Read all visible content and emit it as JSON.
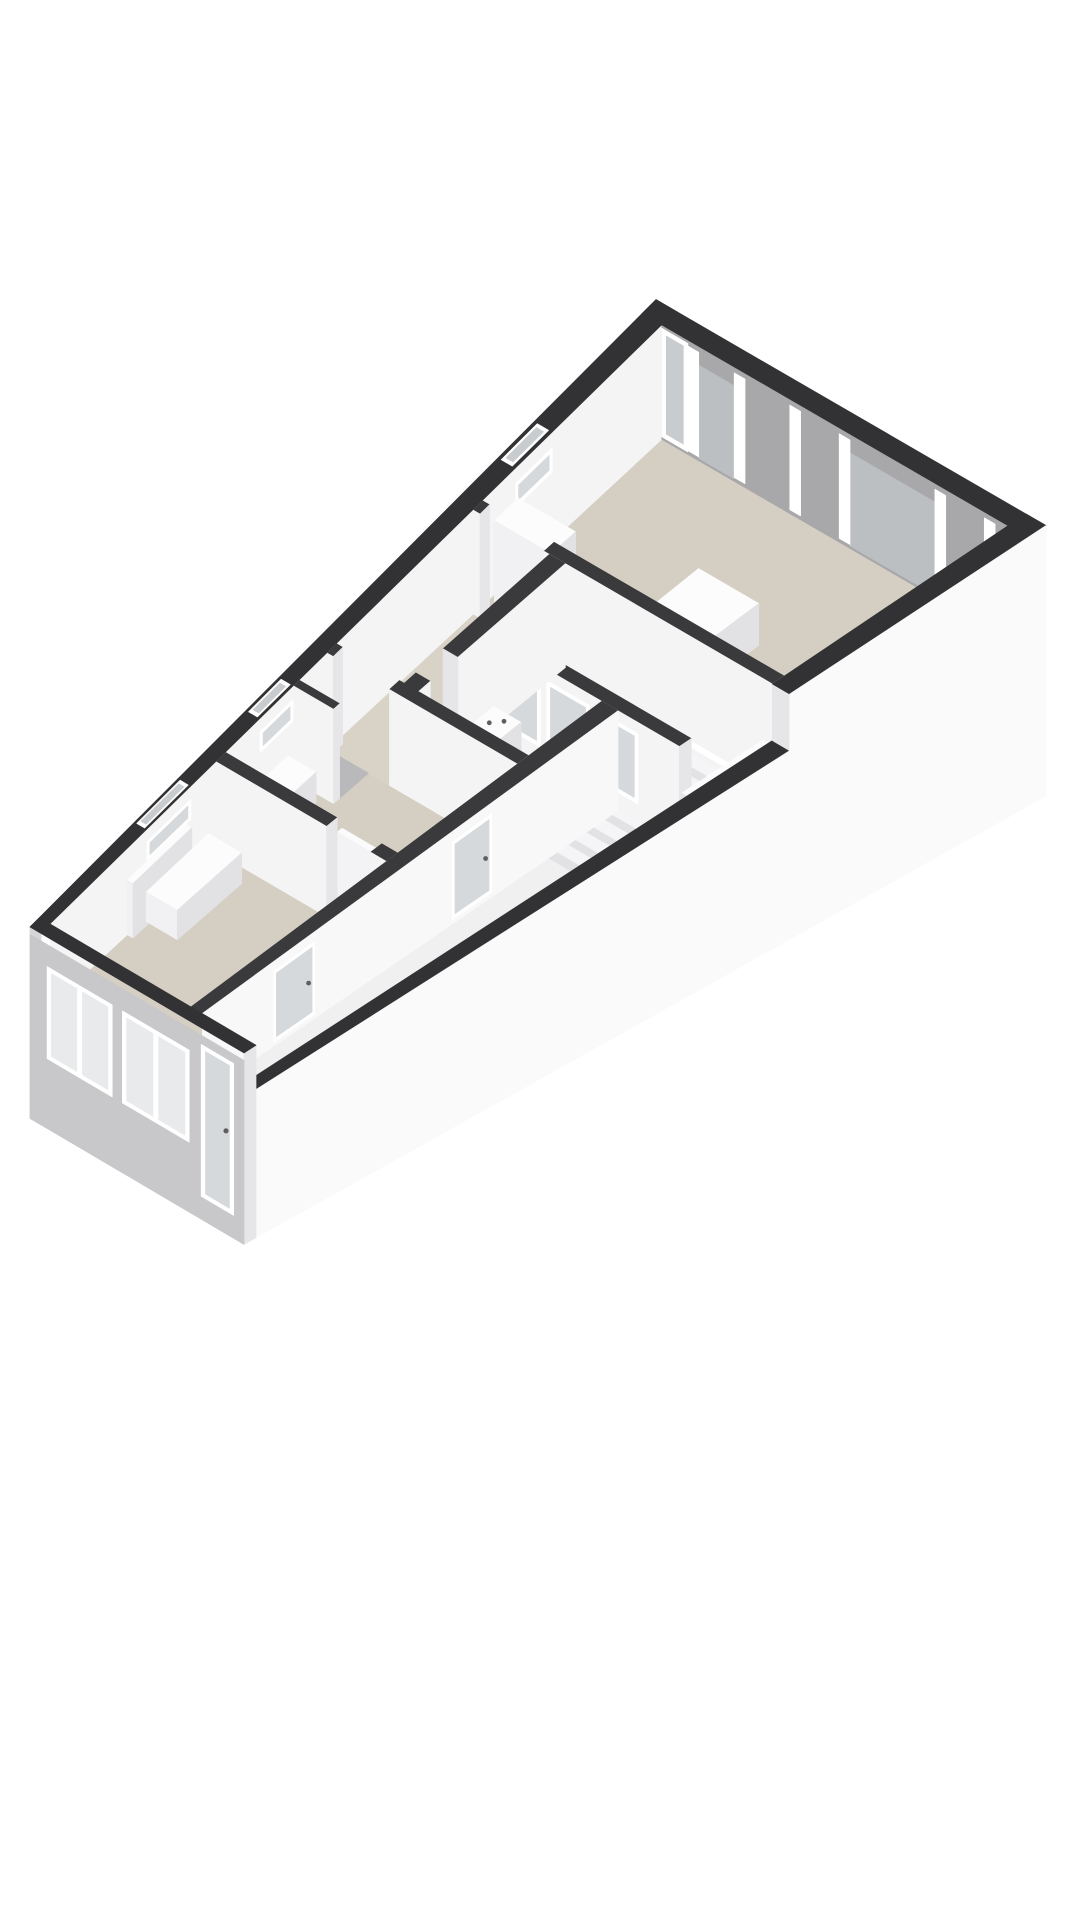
{
  "scene": {
    "kind": "3d-floorplan-isometric-render",
    "background": "#ffffff"
  },
  "palette": {
    "wall_top": "#323234",
    "wall_top_partition": "#3a3a3c",
    "wall_face": "#f4f4f5",
    "wall_face_bright": "#f8f8f9",
    "wall_cap": "#e6e6e8",
    "ne_wall": "#a8a8aa",
    "ne_panel": "#bcbfc1",
    "frame": "#ffffff",
    "glass": "#e8eaec",
    "glass_dark": "#d6d9dc",
    "floor": "#d5cec2",
    "floor_light": "#d9d3c7",
    "floor_gallery": "#f0f0f1",
    "floor_niche": "#b9b9bb",
    "pit_floor": "#c6c6c8",
    "shaft_nw": "#e9e9eb",
    "shaft_e": "#f3f3f4",
    "facade_front": "#c8c8ca",
    "facade_side": "#fafafb",
    "furn_top": "#fcfcfd",
    "furn_sw": "#f1f1f3",
    "furn_se": "#e2e2e5",
    "tread_top": "#f5f5f7",
    "tread_front": "#e2e2e5",
    "toilet_rim": "#8a8a8d",
    "toilet_inner": "#ebebee",
    "metal": "#5f5f62",
    "post": "#dcdcde"
  },
  "model": {
    "building": {
      "length": 870,
      "width": 250,
      "wall_height": 88,
      "plinth": 120,
      "corners": {
        "w": [
          30,
          1008
        ],
        "n": [
          656,
          414
        ],
        "e": [
          1046,
          640
        ],
        "s": [
          244,
          1134
        ]
      }
    },
    "floors": [
      {
        "name": "room-c-floor",
        "r": [
          605,
          13,
          857,
          237
        ],
        "c": "floor"
      },
      {
        "name": "corridor-floor",
        "r": [
          405,
          13,
          592,
          82
        ],
        "c": "floor_light"
      },
      {
        "name": "wc-floor",
        "r": [
          405,
          82,
          490,
          175
        ],
        "c": "floor_light"
      },
      {
        "name": "room-b-floor",
        "r": [
          253,
          13,
          392,
          175
        ],
        "c": "floor"
      },
      {
        "name": "room-a-floor",
        "r": [
          13,
          13,
          240,
          175
        ],
        "c": "floor"
      },
      {
        "name": "threshold-a-b",
        "r": [
          240,
          118,
          253,
          160
        ],
        "c": "floor"
      },
      {
        "name": "threshold-b-hall",
        "r": [
          392,
          18,
          405,
          66
        ],
        "c": "floor_light"
      },
      {
        "name": "threshold-hall-c",
        "r": [
          592,
          18,
          605,
          66
        ],
        "c": "floor"
      },
      {
        "name": "threshold-wc",
        "r": [
          420,
          70,
          455,
          82
        ],
        "c": "floor_light"
      },
      {
        "name": "niche-floor",
        "r": [
          354,
          13,
          392,
          48
        ],
        "c": "floor_niche"
      },
      {
        "name": "gallery-floor",
        "r": [
          13,
          188,
          490,
          237
        ],
        "c": "floor_gallery"
      }
    ],
    "nw_wall": {
      "slits": [
        [
          145,
          205
        ],
        [
          300,
          345
        ],
        [
          650,
          700
        ]
      ]
    },
    "ne_wall": {
      "u0": 850,
      "u1": 870,
      "door_frame": [
        13,
        30
      ],
      "panels": [
        [
          37,
          60
        ],
        [
          135,
          190
        ]
      ],
      "mullions": [
        [
          30,
          37
        ],
        [
          60,
          67
        ],
        [
          96,
          103
        ],
        [
          128,
          135
        ],
        [
          190,
          197
        ],
        [
          222,
          229
        ]
      ]
    },
    "partition_hall_c": {
      "u": 592,
      "t": 13,
      "v0": 13,
      "v1": 237,
      "gap": [
        18,
        66
      ]
    },
    "partition_b_hall": {
      "u": 392,
      "t": 13,
      "v0": 13,
      "v1": 175,
      "gap": [
        18,
        66
      ]
    },
    "partition_a_b": {
      "u": 240,
      "t": 13,
      "v0": 13,
      "v1": 175,
      "gap": [
        118,
        160
      ]
    },
    "shaft_west_wall": {
      "u": 490,
      "t": 13,
      "v0": 82,
      "v1": 237,
      "panes": [
        [
          92,
          126
        ],
        [
          131,
          165
        ],
        [
          170,
          204
        ]
      ]
    },
    "wc_wall": {
      "v": 70,
      "t": 12,
      "u0": 405,
      "u1": 592,
      "gap": [
        420,
        455
      ]
    },
    "se_inner_wall": {
      "v": 175,
      "t": 13,
      "u0": 13,
      "u1": 490,
      "glass_doors": [
        [
          95,
          142
        ],
        [
          300,
          345
        ]
      ]
    },
    "stairs": {
      "shaft": [
        503,
        82,
        585,
        230
      ],
      "pit_depth": 64,
      "tread_count": 8,
      "tread_depth": 13,
      "top_u": 585,
      "v0": 92,
      "v1": 226,
      "drop": 8,
      "balustrade": {
        "u0": 503,
        "u1": 592,
        "v0": 230,
        "v1": 237,
        "h": 36,
        "posts": 6
      }
    },
    "kitchen": [
      {
        "name": "kitchen-counter",
        "box": [
          608,
          20,
          640,
          150,
          40
        ]
      },
      {
        "name": "kitchen-tall-cabinet",
        "box": [
          608,
          20,
          640,
          62,
          74
        ]
      },
      {
        "name": "kitchen-island",
        "box": [
          640,
          108,
          714,
          150,
          34
        ]
      }
    ],
    "furniture_b": [
      {
        "name": "sideboard",
        "box": [
          262,
          13,
          338,
          38,
          28
        ]
      }
    ],
    "furniture_a": [
      {
        "name": "radiator",
        "box": [
          118,
          13,
          198,
          19,
          56
        ]
      },
      {
        "name": "radiator-cabinet",
        "box": [
          140,
          16,
          225,
          48,
          30
        ]
      }
    ],
    "door_leaf_open": {
      "box": [
        253,
        118,
        259,
        158,
        74
      ]
    },
    "niche_stub_wall": {
      "u": 346,
      "t": 8,
      "v0": 13,
      "v1": 48
    },
    "wc_fixtures": {
      "sink": {
        "box": [
          462,
          90,
          488,
          112,
          30
        ],
        "taps": [
          [
            470,
            98
          ],
          [
            479,
            104
          ]
        ]
      },
      "toilet": {
        "tank": [
          425,
          162,
          455,
          174,
          26
        ],
        "bowl_center": [
          440,
          146
        ],
        "bowl_rv": 14,
        "bowl_ru": 9
      }
    },
    "parapet": {
      "u0": 13,
      "u1": 592,
      "v0": 237,
      "v1": 250,
      "h": 40
    },
    "sw_facade": {
      "windows": [
        {
          "v0": 20,
          "v1": 96,
          "ztop": 56,
          "zbot": -44
        },
        {
          "v0": 108,
          "v1": 186,
          "ztop": 56,
          "zbot": -44
        }
      ],
      "door": {
        "v0": 200,
        "v1": 238,
        "ztop": 70,
        "zbot": -95
      }
    }
  }
}
